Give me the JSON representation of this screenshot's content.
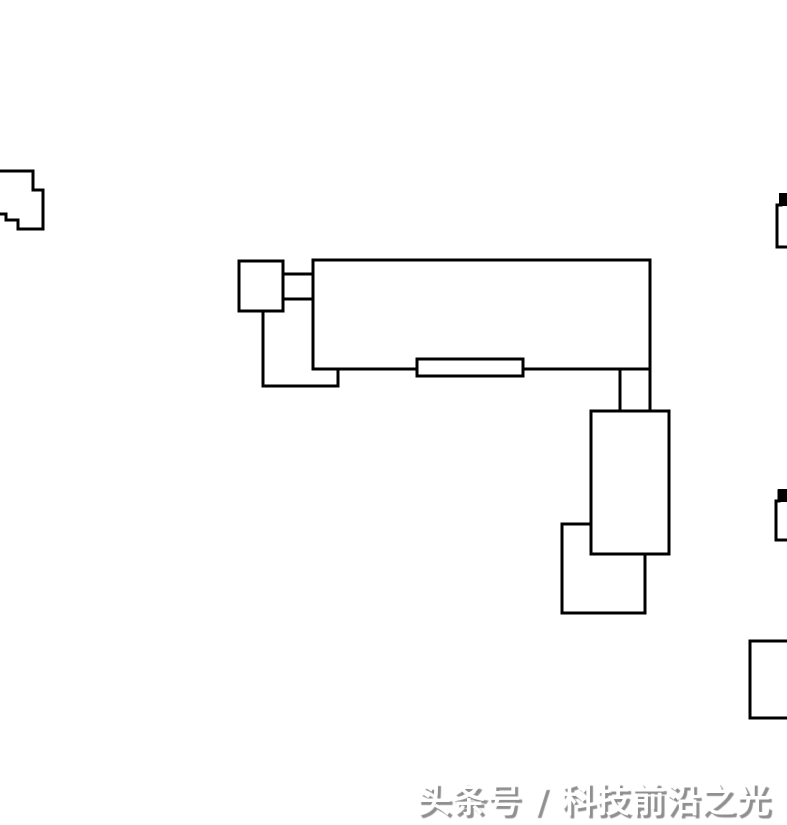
{
  "page": {
    "background": "#ffffff",
    "width": 787,
    "height": 825
  },
  "watermark": {
    "text": "头条号 / 科技前沿之光",
    "fill_color": "#ffffff",
    "shadow_color": "#8f8f8f"
  },
  "drawing": {
    "description": "black outlined floor-plan style building footprints on white background",
    "stroke_color": "#000000",
    "fill_color": "#ffffff",
    "stroke_width": 3,
    "shapes": [
      {
        "name": "left-edge-partial-outline",
        "type": "path",
        "d": "M -4 171 L 33 171 L 33 190 L 43 190 L 43 229 L 18 229 L 18 220 L 6 220 L 6 214 L -4 214 Z",
        "fill": "white"
      },
      {
        "name": "lower-left-step-lines",
        "type": "path",
        "d": "M 263 311 L 263 386 L 338 386 L 338 369",
        "fill": "none"
      },
      {
        "name": "connector-box",
        "type": "rect",
        "x": 283,
        "y": 274,
        "w": 30,
        "h": 25,
        "fill": "white"
      },
      {
        "name": "main-horizontal-block",
        "type": "rect",
        "x": 313,
        "y": 260,
        "w": 337,
        "h": 109,
        "fill": "white"
      },
      {
        "name": "neck-line-left",
        "type": "path",
        "d": "M 620 369 L 620 411",
        "fill": "none"
      },
      {
        "name": "neck-line-right",
        "type": "path",
        "d": "M 650 369 L 650 411",
        "fill": "none"
      },
      {
        "name": "bottom-bar",
        "type": "rect",
        "x": 417,
        "y": 359,
        "w": 106,
        "h": 17,
        "fill": "white"
      },
      {
        "name": "top-left-square",
        "type": "rect",
        "x": 239,
        "y": 261,
        "w": 44,
        "h": 50,
        "fill": "white"
      },
      {
        "name": "lower-overlap-square",
        "type": "rect",
        "x": 562,
        "y": 524,
        "w": 83,
        "h": 89,
        "fill": "white"
      },
      {
        "name": "tall-vertical-block",
        "type": "rect",
        "x": 591,
        "y": 411,
        "w": 78,
        "h": 143,
        "fill": "white"
      },
      {
        "name": "right-upper-partial-outline",
        "type": "path",
        "d": "M 792 196 L 781 196 L 781 205 L 777 205 L 777 247 L 792 247",
        "fill": "white"
      },
      {
        "name": "right-upper-tab",
        "type": "path",
        "d": "M 779 193 L 792 193 L 792 206 L 779 206 Z",
        "fill": "black"
      },
      {
        "name": "right-middle-partial-outline",
        "type": "path",
        "d": "M 792 491 L 779 491 L 779 501 L 776 501 L 776 540 L 792 540",
        "fill": "white"
      },
      {
        "name": "right-middle-tab",
        "type": "path",
        "d": "M 778 489 L 792 489 L 792 502 L 778 502 Z",
        "fill": "black"
      },
      {
        "name": "bottom-right-partial-rect",
        "type": "rect",
        "x": 750,
        "y": 641,
        "w": 46,
        "h": 77,
        "fill": "white"
      }
    ]
  }
}
